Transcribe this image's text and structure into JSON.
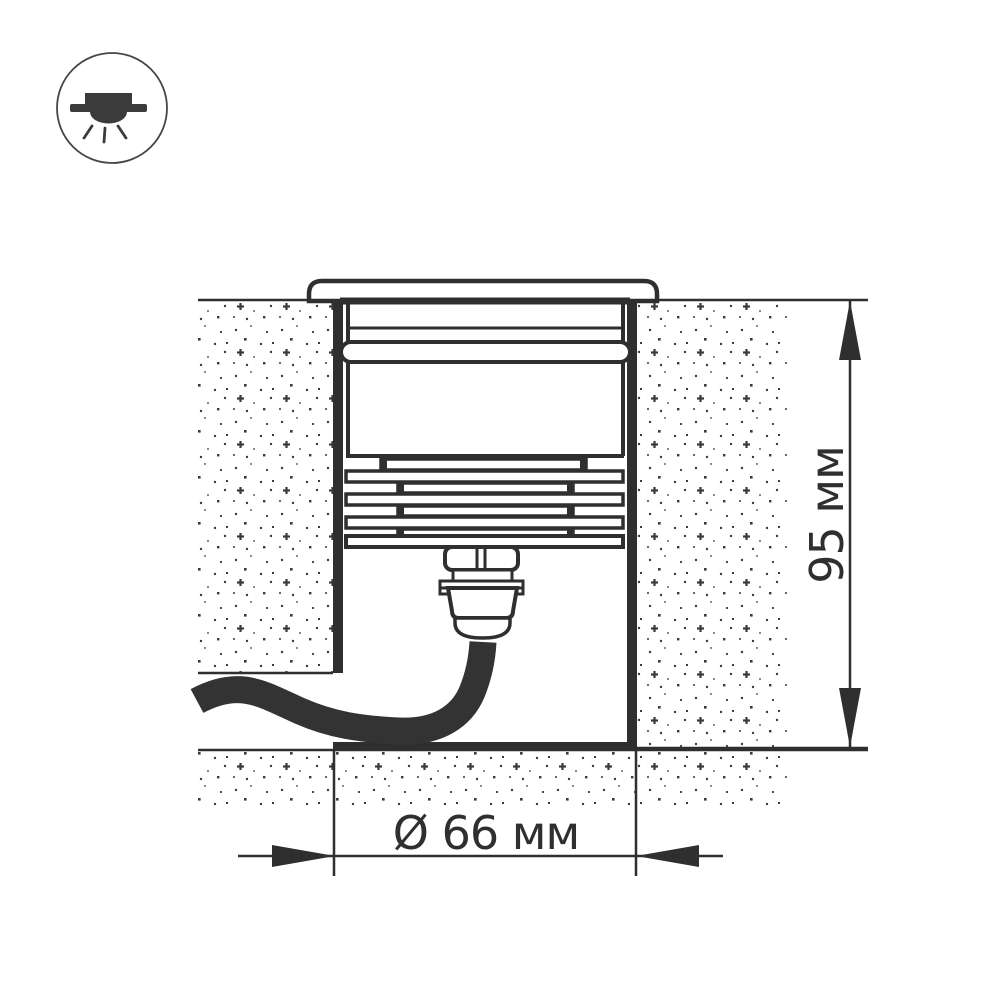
{
  "diagram": {
    "icon": "recessed-ground-light",
    "labels": {
      "height": "95 мм",
      "diameter": "Ø 66 мм"
    },
    "colors": {
      "line": "#2f2f2f",
      "background": "#ffffff",
      "stipple": "#3a3a3a"
    }
  }
}
